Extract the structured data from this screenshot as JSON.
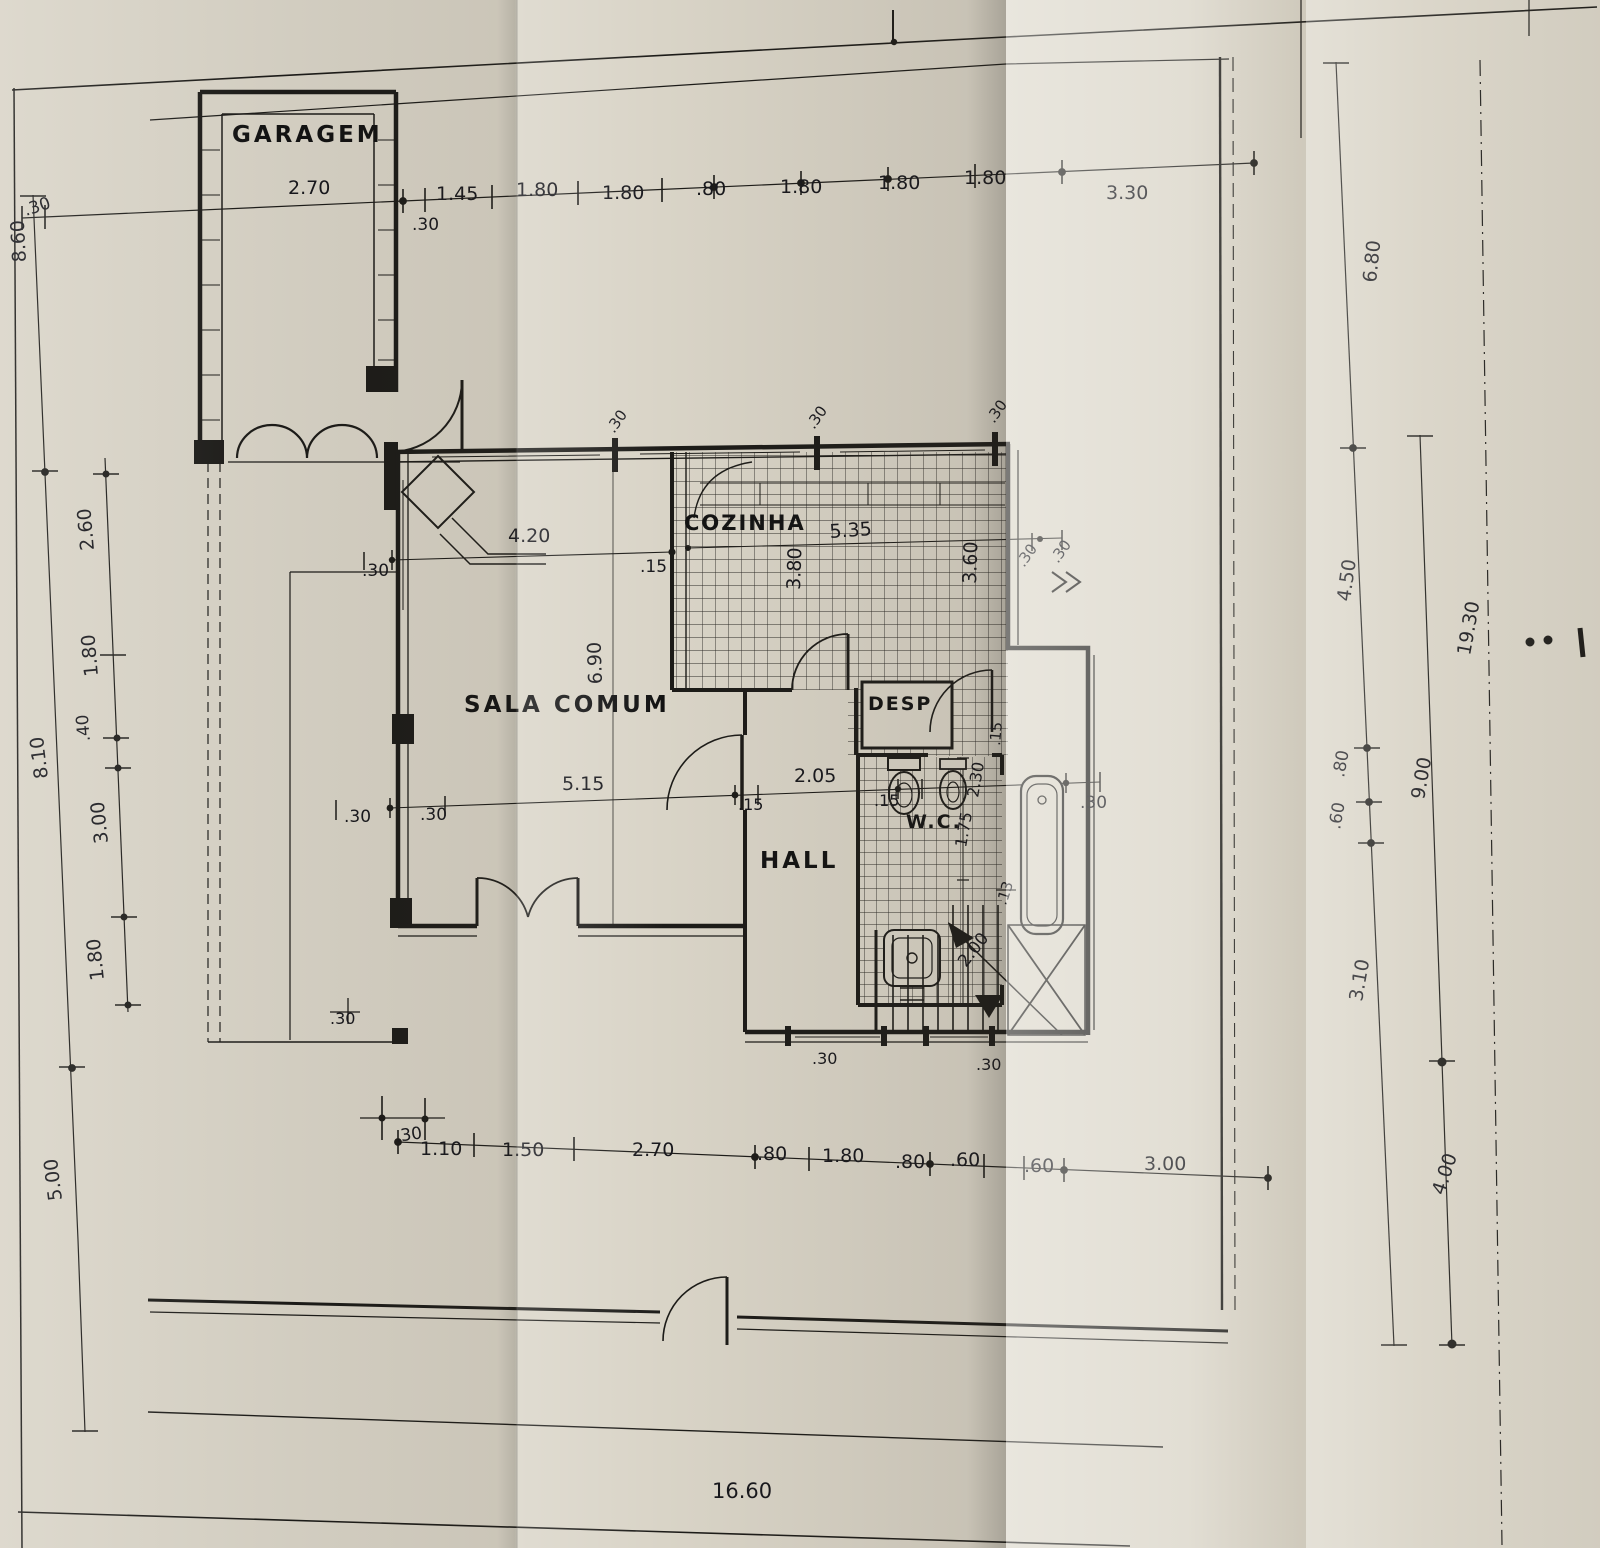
{
  "drawing": {
    "kind": "floor-plan",
    "ink_color": "#1c1b18",
    "paper_color": "#d9d4c7"
  },
  "rooms": {
    "garagem": "GARAGEM",
    "sala": "SALA COMUM",
    "cozinha": "COZINHA",
    "desp": "DESP",
    "wc": "W.C.",
    "hall": "HALL"
  },
  "dims": {
    "top": [
      ".30",
      "2.70",
      ".30",
      "1.45",
      "1.80",
      "1.80",
      ".80",
      "1.80",
      "1.80",
      "1.80",
      "3.30"
    ],
    "left": [
      "8.60",
      "8.10",
      "5.00",
      "2.60",
      "1.80",
      ".40",
      "3.00",
      "1.80"
    ],
    "right": [
      "6.80",
      "4.50",
      "19.30",
      ".80",
      ".60",
      "9.00",
      "3.10",
      "4.00"
    ],
    "bottom": [
      ".30",
      "1.10",
      "1.50",
      "2.70",
      ".80",
      "1.80",
      ".80",
      ".60",
      ".60",
      "3.00",
      "16.60"
    ],
    "inner": [
      "4.20",
      ".30",
      ".15",
      "6.90",
      "5.35",
      "3.80",
      "3.60",
      ".30",
      ".30",
      "5.15",
      ".30",
      ".30",
      "2.05",
      ".15",
      ".15",
      "2.30",
      "1.75",
      ".30",
      ".13",
      "2.00",
      ".30",
      ".30",
      ".30",
      ".30",
      ".30",
      ".30",
      ".15"
    ]
  }
}
